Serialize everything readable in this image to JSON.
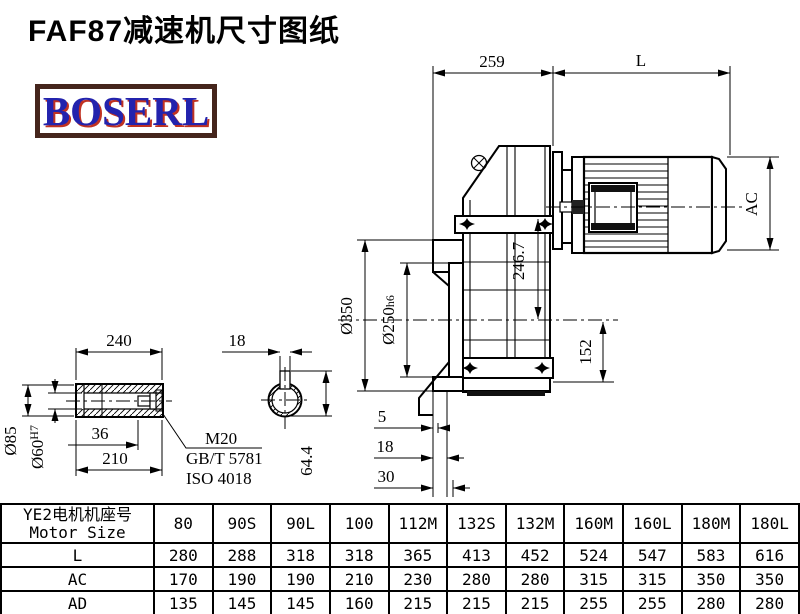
{
  "title": "FAF87减速机尺寸图纸",
  "logo": {
    "text": "BOSERL",
    "text_color": "#2323ad",
    "shadow_color": "#c03222",
    "border_color": "#45251c"
  },
  "drawing": {
    "dims": {
      "housing_width": "259",
      "motor_length": "L",
      "motor_diameter": "AC",
      "flange_od": "Ø350",
      "spigot_d": "Ø250",
      "spigot_tol": "h6",
      "axis_height": "246.7",
      "foot_height": "152",
      "flange_offset_1": "5",
      "flange_offset_2": "18",
      "flange_offset_3": "30",
      "shaft_length": "240",
      "shaft_od": "Ø85",
      "bore_d": "Ø60",
      "bore_tol": "H7",
      "bolt_depth": "36",
      "hub_length": "210",
      "key_width": "18",
      "key_depth": "64.4",
      "bolt_spec": "M20",
      "bolt_std_1": "GB/T 5781",
      "bolt_std_2": "ISO 4018"
    }
  },
  "table": {
    "header_cn": "YE2电机机座号",
    "header_en": "Motor Size",
    "columns": [
      "80",
      "90S",
      "90L",
      "100",
      "112M",
      "132S",
      "132M",
      "160M",
      "160L",
      "180M",
      "180L"
    ],
    "rows": [
      {
        "label": "L",
        "values": [
          "280",
          "288",
          "318",
          "318",
          "365",
          "413",
          "452",
          "524",
          "547",
          "583",
          "616"
        ]
      },
      {
        "label": "AC",
        "values": [
          "170",
          "190",
          "190",
          "210",
          "230",
          "280",
          "280",
          "315",
          "315",
          "350",
          "350"
        ]
      },
      {
        "label": "AD",
        "values": [
          "135",
          "145",
          "145",
          "160",
          "215",
          "215",
          "215",
          "255",
          "255",
          "280",
          "280"
        ]
      }
    ]
  }
}
